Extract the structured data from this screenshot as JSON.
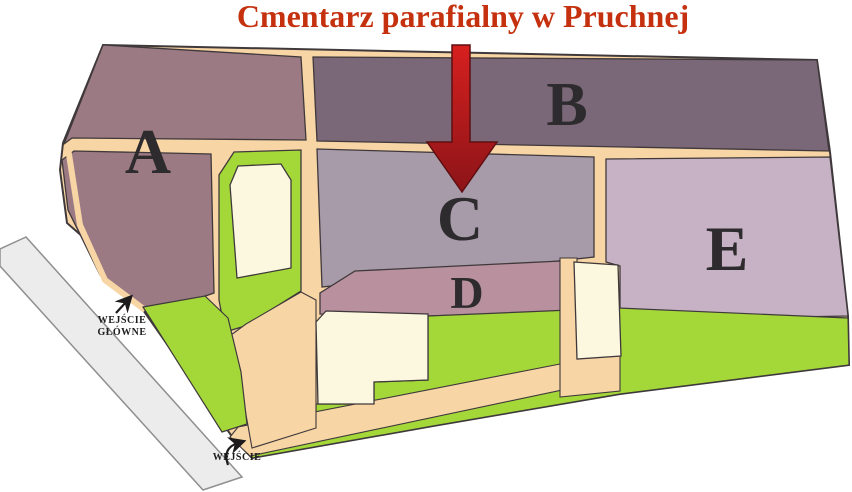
{
  "title": {
    "text": "Cmentarz parafialny w Pruchnej",
    "color": "#c5310e"
  },
  "sections": [
    {
      "id": "A",
      "label": "A",
      "color": "#9b7a83"
    },
    {
      "id": "B",
      "label": "B",
      "color": "#7a6777"
    },
    {
      "id": "C",
      "label": "C",
      "color": "#a79aa9"
    },
    {
      "id": "D",
      "label": "D",
      "color": "#b9909e"
    },
    {
      "id": "E",
      "label": "E",
      "color": "#c7b2c5"
    }
  ],
  "entrances": [
    {
      "label_lines": [
        "WEJŚCIE",
        "GŁÓWNE"
      ]
    },
    {
      "label_lines": [
        "WEJŚCIE"
      ]
    }
  ],
  "map_colors": {
    "path": "#f8d5a5",
    "grass": "#a4d838",
    "building": "#fcf8df",
    "road": "#ececec",
    "label": "#2e2b2e",
    "arrow_top": "#d6201f",
    "arrow_bottom": "#8c1418"
  }
}
